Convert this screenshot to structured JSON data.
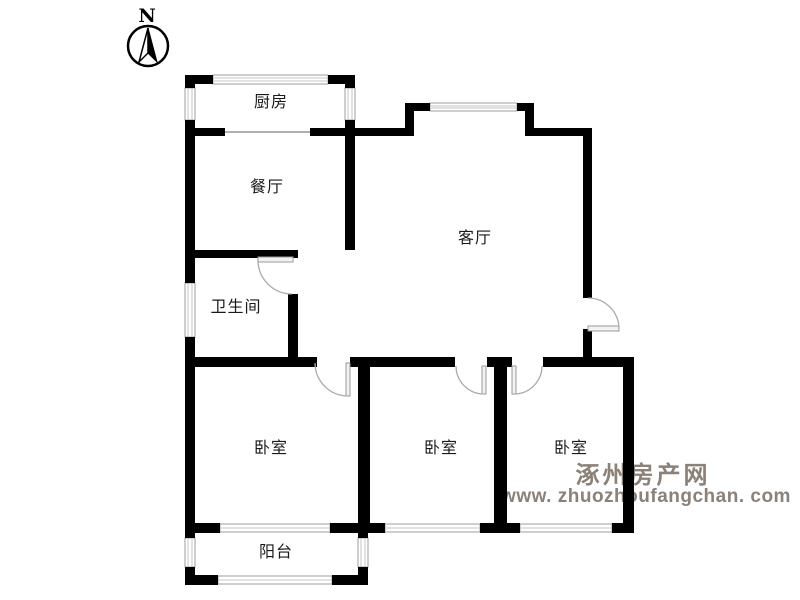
{
  "compass": {
    "north_label": "N"
  },
  "rooms": {
    "kitchen": "厨房",
    "dining": "餐厅",
    "living": "客厅",
    "bathroom": "卫生间",
    "bedroom_left": "卧室",
    "bedroom_middle": "卧室",
    "bedroom_right": "卧室",
    "balcony": "阳台"
  },
  "watermark": {
    "site_name": "涿州房产网",
    "site_url": "www. zhuozhoufangchan. com",
    "color": "#8b8178"
  },
  "colors": {
    "wall": "#000000",
    "window_line": "#c6c6c6",
    "window_frame": "#9e9e9e",
    "door_line": "#aaaaaa",
    "label_text": "#1a1a1a",
    "background": "#ffffff"
  }
}
